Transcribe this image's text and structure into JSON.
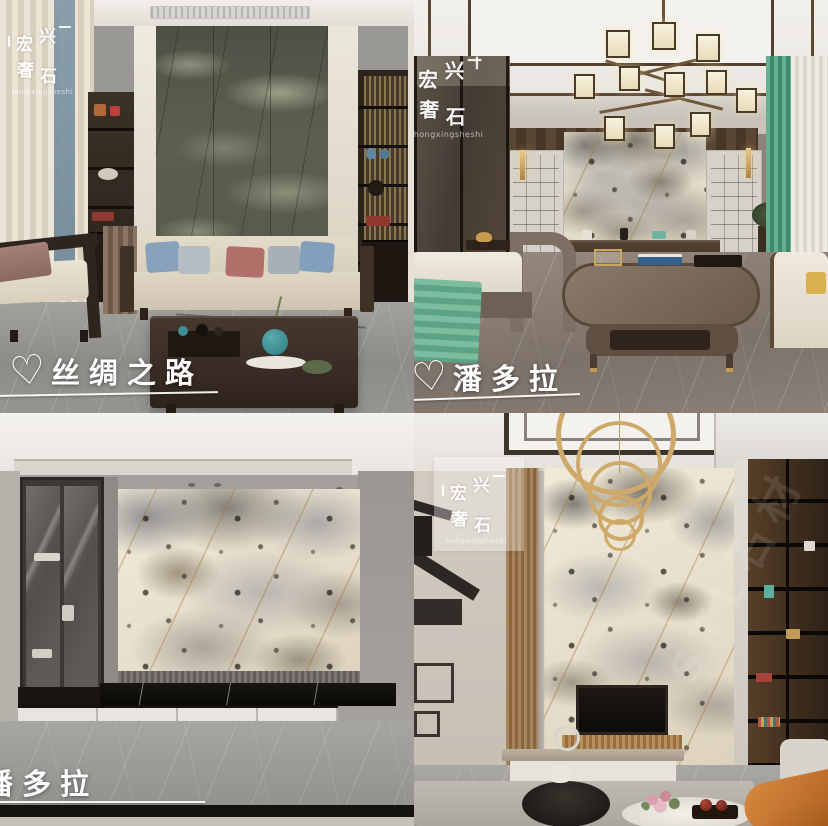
{
  "brand": {
    "chars": [
      "宏",
      "兴",
      "奢",
      "石"
    ],
    "latin": "hongxingsheshi"
  },
  "icons": {
    "heart": "♡"
  },
  "photos": [
    {
      "caption": "丝绸之路"
    },
    {
      "caption": "潘多拉"
    },
    {
      "caption": "潘多拉"
    },
    {
      "caption": ""
    }
  ],
  "faint_watermark": "STL石材",
  "colors": {
    "caption_text": "#ffffff",
    "teal_accent": "#66b092",
    "gold_accent": "#cfa96a",
    "green_marble": "#5c6050",
    "patagonia_base": "#e9e2d1",
    "floor_grey": "#98968f",
    "dark_wood": "#3a2f26",
    "orange_chair": "#c9742e"
  }
}
